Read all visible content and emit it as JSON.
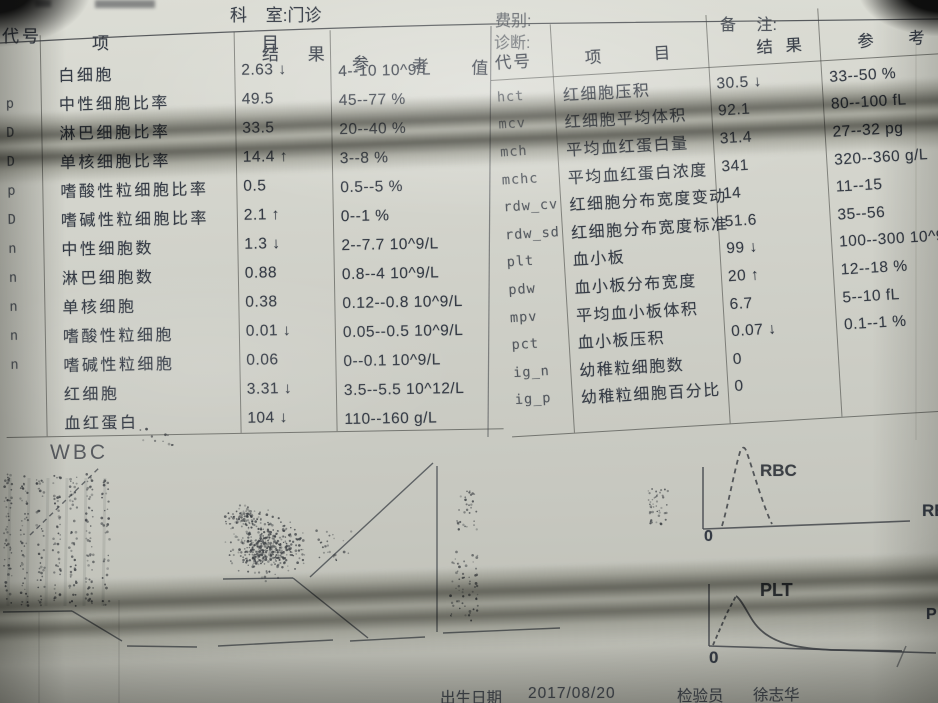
{
  "header": {
    "dept_label": "科 室:门诊",
    "fee_label": "费别:",
    "diagnosis_label": "诊断:",
    "remark_label": "备 注:"
  },
  "left_table": {
    "columns": [
      "代号",
      "项 目",
      "结 果",
      "参 考 值"
    ],
    "rows": [
      {
        "code": "",
        "item": "白细胞",
        "result": "2.63 ↓",
        "ref": "4--10 10^9/L"
      },
      {
        "code": "p",
        "item": "中性细胞比率",
        "result": "49.5",
        "ref": "45--77 %"
      },
      {
        "code": "D",
        "item": "淋巴细胞比率",
        "result": "33.5",
        "ref": "20--40 %"
      },
      {
        "code": "D",
        "item": "单核细胞比率",
        "result": "14.4 ↑",
        "ref": "3--8 %"
      },
      {
        "code": "p",
        "item": "嗜酸性粒细胞比率",
        "result": "0.5",
        "ref": "0.5--5 %"
      },
      {
        "code": "D",
        "item": "嗜碱性粒细胞比率",
        "result": "2.1 ↑",
        "ref": "0--1 %"
      },
      {
        "code": "n",
        "item": "中性细胞数",
        "result": "1.3 ↓",
        "ref": "2--7.7 10^9/L"
      },
      {
        "code": "n",
        "item": "淋巴细胞数",
        "result": "0.88",
        "ref": "0.8--4 10^9/L"
      },
      {
        "code": "n",
        "item": "单核细胞",
        "result": "0.38",
        "ref": "0.12--0.8 10^9/L"
      },
      {
        "code": "n",
        "item": "嗜酸性粒细胞",
        "result": "0.01 ↓",
        "ref": "0.05--0.5 10^9/L"
      },
      {
        "code": "n",
        "item": "嗜碱性粒细胞",
        "result": "0.06",
        "ref": "0--0.1 10^9/L"
      },
      {
        "code": "",
        "item": "红细胞",
        "result": "3.31 ↓",
        "ref": "3.5--5.5 10^12/L"
      },
      {
        "code": "",
        "item": "血红蛋白",
        "result": "104 ↓",
        "ref": "110--160 g/L"
      }
    ]
  },
  "right_table": {
    "columns": [
      "代号",
      "项 目",
      "结 果",
      "参 考 值"
    ],
    "rows": [
      {
        "code": "hct",
        "item": "红细胞压积",
        "result": "30.5 ↓",
        "ref": "33--50 %"
      },
      {
        "code": "mcv",
        "item": "红细胞平均体积",
        "result": "92.1",
        "ref": "80--100 fL"
      },
      {
        "code": "mch",
        "item": "平均血红蛋白量",
        "result": "31.4",
        "ref": "27--32 pg"
      },
      {
        "code": "mchc",
        "item": "平均血红蛋白浓度",
        "result": "341",
        "ref": "320--360 g/L"
      },
      {
        "code": "rdw_cv",
        "item": "红细胞分布宽度变动",
        "result": "14",
        "ref": "11--15"
      },
      {
        "code": "rdw_sd",
        "item": "红细胞分布宽度标准",
        "result": "51.6",
        "ref": "35--56"
      },
      {
        "code": "plt",
        "item": "血小板",
        "result": "99 ↓",
        "ref": "100--300 10^9/L"
      },
      {
        "code": "pdw",
        "item": "血小板分布宽度",
        "result": "20 ↑",
        "ref": "12--18 %"
      },
      {
        "code": "mpv",
        "item": "平均血小板体积",
        "result": "6.7",
        "ref": "5--10 fL"
      },
      {
        "code": "pct",
        "item": "血小板压积",
        "result": "0.07 ↓",
        "ref": "0.1--1 %"
      },
      {
        "code": "ig_n",
        "item": "幼稚粒细胞数",
        "result": "0",
        "ref": ""
      },
      {
        "code": "ig_p",
        "item": "幼稚粒细胞百分比",
        "result": "0",
        "ref": ""
      }
    ]
  },
  "graphs": {
    "wbc": {
      "label": "WBC",
      "solid_lines": [
        [
          3,
          612,
          72,
          611
        ],
        [
          72,
          611,
          122,
          641
        ],
        [
          127,
          646,
          197,
          647
        ],
        [
          218,
          646,
          333,
          640
        ],
        [
          223,
          579,
          293,
          578
        ],
        [
          293,
          578,
          368,
          638
        ],
        [
          350,
          641,
          425,
          637
        ],
        [
          437,
          466,
          437,
          632
        ],
        [
          310,
          577,
          433,
          463
        ],
        [
          443,
          633,
          560,
          628
        ]
      ],
      "dashed_lines": [
        [
          30,
          535,
          100,
          467
        ]
      ],
      "clusters": [
        {
          "type": "streaks",
          "x": 4,
          "y": 474,
          "w": 114,
          "h": 132,
          "count": 330
        },
        {
          "type": "gauss",
          "cx": 267,
          "cy": 549,
          "rx": 48,
          "ry": 36,
          "count": 400
        },
        {
          "type": "gauss",
          "cx": 246,
          "cy": 518,
          "rx": 28,
          "ry": 16,
          "count": 90
        },
        {
          "type": "uniform",
          "x": 450,
          "y": 548,
          "w": 28,
          "h": 74,
          "count": 60
        },
        {
          "type": "uniform",
          "x": 455,
          "y": 490,
          "w": 22,
          "h": 40,
          "count": 30
        },
        {
          "type": "uniform",
          "x": 648,
          "y": 488,
          "w": 20,
          "h": 38,
          "count": 45
        },
        {
          "type": "uniform",
          "x": 140,
          "y": 428,
          "w": 34,
          "h": 20,
          "count": 12
        },
        {
          "type": "uniform",
          "x": 316,
          "y": 530,
          "w": 36,
          "h": 32,
          "count": 26
        }
      ]
    },
    "rbc": {
      "label": "RBC",
      "zero": "0",
      "edge_label": "RB",
      "axes": [
        [
          703,
          467,
          703,
          529
        ],
        [
          703,
          529,
          910,
          521
        ]
      ],
      "curve": "M722,526 C728,506 734,472 740,452 C742,446 745,446 747,453 C753,470 763,506 772,524",
      "curve_dash": "5 4"
    },
    "plt": {
      "label": "PLT",
      "zero": "0",
      "edge_label": "P",
      "axes": [
        [
          709,
          584,
          709,
          646
        ],
        [
          709,
          646,
          936,
          653
        ]
      ],
      "rise": "M713,645 L727,613 L736,596",
      "fall": "M736,596 C741,599 747,612 753,621 C761,633 773,640 787,644 C801,648 816,649 831,650 L902,651"
    },
    "table_lines": {
      "top_sag": "M0,43 Q250,29 492,24 L938,19",
      "between_tables": [
        491,
        26,
        488,
        437
      ],
      "stray_mark": [
        897,
        667,
        906,
        646
      ]
    }
  },
  "footer": {
    "birth_label": "出生日期",
    "birth_date": "2017/08/20",
    "examiner_label": "检验员",
    "examiner_name": "徐志华"
  }
}
